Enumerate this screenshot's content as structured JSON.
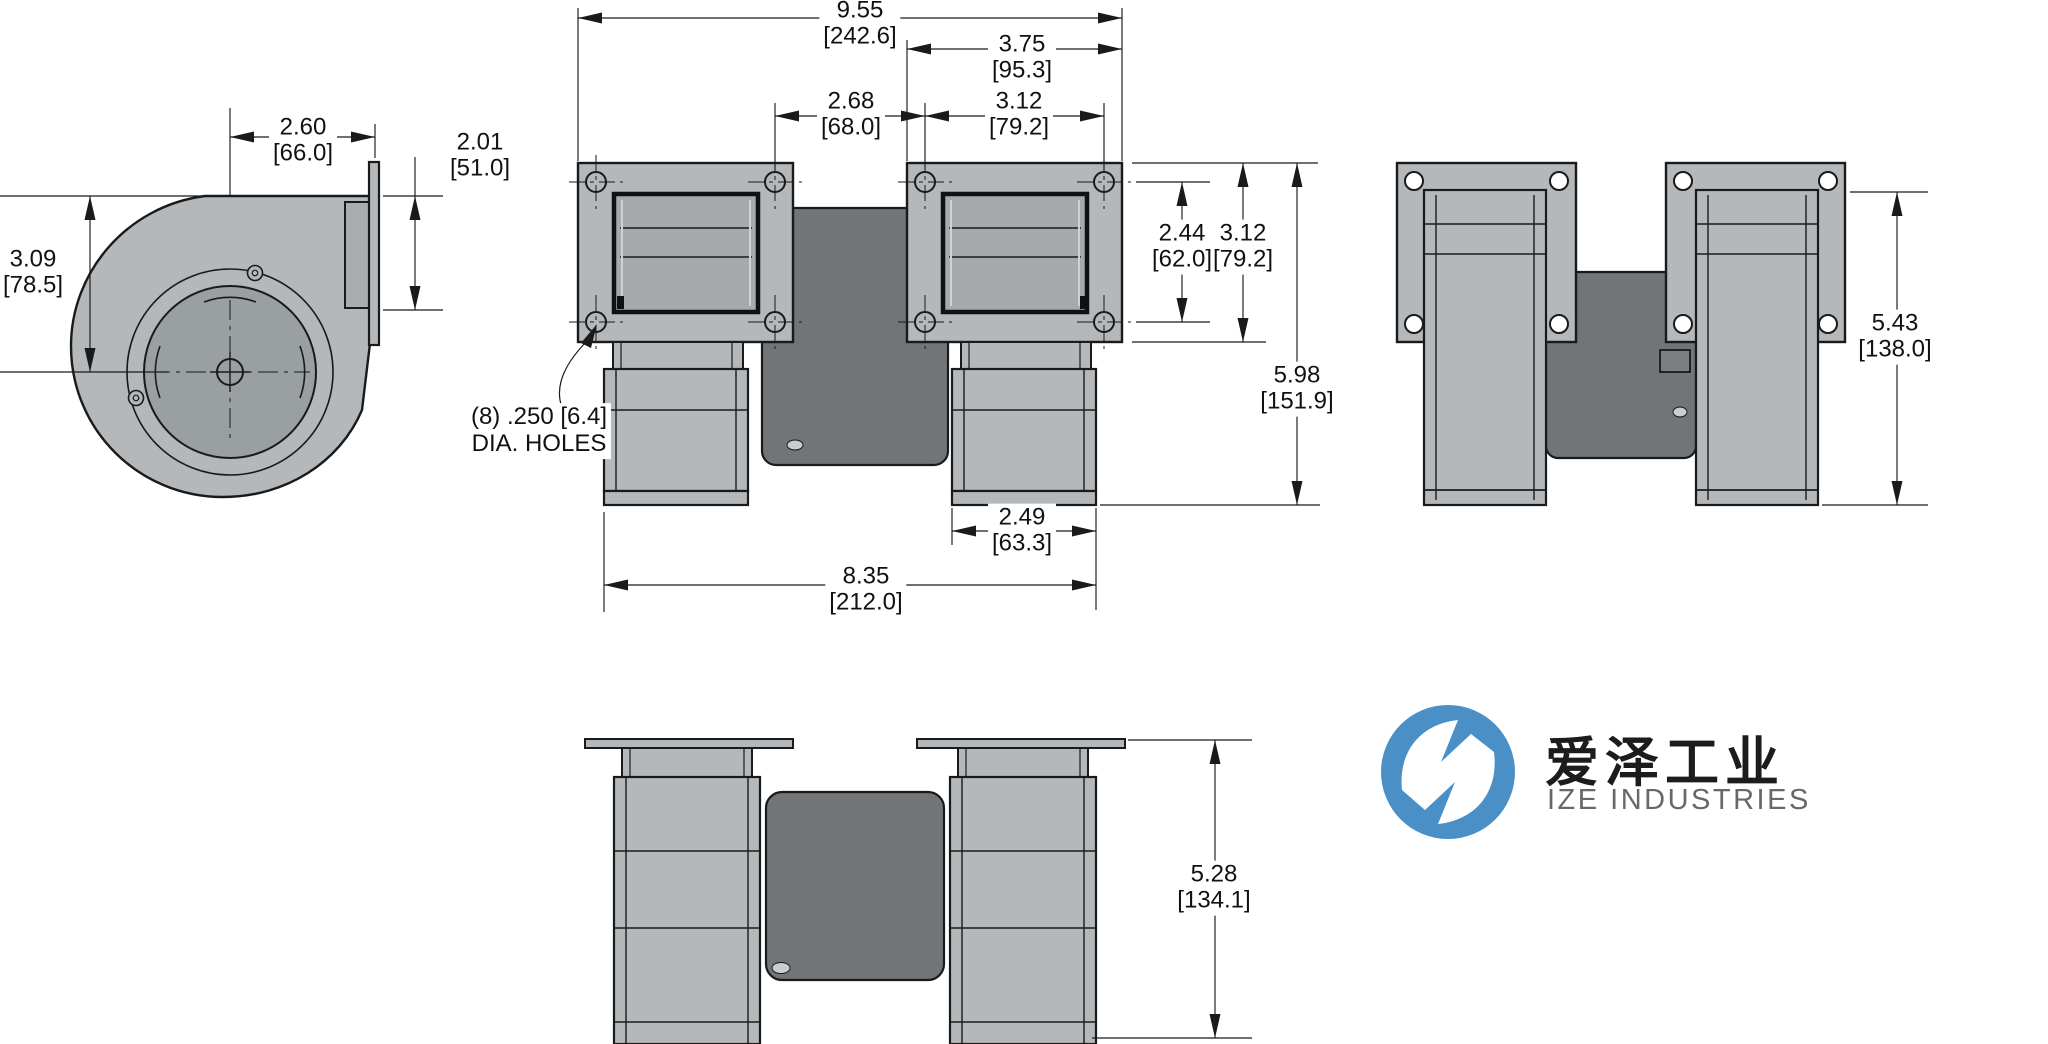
{
  "dims": {
    "d260": {
      "in": "2.60",
      "mm": "[66.0]"
    },
    "d201": {
      "in": "2.01",
      "mm": "[51.0]"
    },
    "d309": {
      "in": "3.09",
      "mm": "[78.5]"
    },
    "d955": {
      "in": "9.55",
      "mm": "[242.6]"
    },
    "d375": {
      "in": "3.75",
      "mm": "[95.3]"
    },
    "d268": {
      "in": "2.68",
      "mm": "[68.0]"
    },
    "d312h": {
      "in": "3.12",
      "mm": "[79.2]"
    },
    "d244": {
      "in": "2.44",
      "mm": "[62.0]"
    },
    "d312v": {
      "in": "3.12",
      "mm": "[79.2]"
    },
    "d598": {
      "in": "5.98",
      "mm": "[151.9]"
    },
    "d249": {
      "in": "2.49",
      "mm": "[63.3]"
    },
    "d835": {
      "in": "8.35",
      "mm": "[212.0]"
    },
    "d543": {
      "in": "5.43",
      "mm": "[138.0]"
    },
    "d528": {
      "in": "5.28",
      "mm": "[134.1]"
    }
  },
  "notes": {
    "holes_line1": "(8) .250 [6.4]",
    "holes_line2": "DIA. HOLES"
  },
  "logo": {
    "chinese": "爱泽工业",
    "english": "IZE INDUSTRIES"
  },
  "colors": {
    "body_gray": "#b4b8ba",
    "motor_gray": "#717578",
    "louver_gray": "#a6aaac",
    "inlet_gray": "#9aa0a2",
    "line": "#1a1a1a",
    "logo_blue": "#4a90c6",
    "logo_text": "#1c1c1c",
    "logo_sub": "#66696c"
  }
}
